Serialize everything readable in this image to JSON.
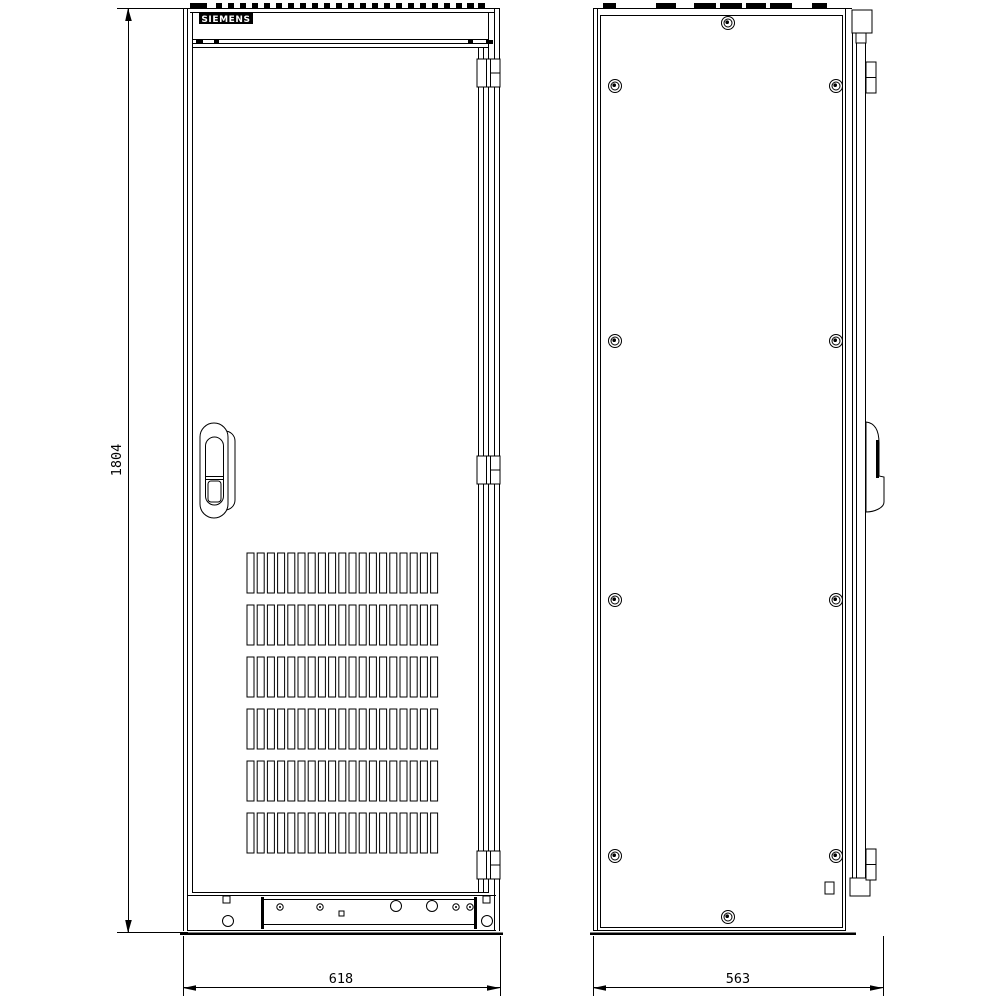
{
  "page": {
    "background": "#ffffff",
    "line_color": "#000000"
  },
  "brand": {
    "logo_text": "SIEMENS"
  },
  "dimensions": {
    "height": {
      "value": "1804"
    },
    "front_width": {
      "value": "618"
    },
    "side_depth": {
      "value": "563"
    }
  },
  "front_view": {
    "vents": {
      "rows": 6,
      "cols": 19,
      "x": 247,
      "y": 553,
      "slot_w": 7,
      "slot_h": 40,
      "col_pitch": 10.2,
      "row_pitch": 52
    },
    "top_dash_segments": [
      [
        190,
        17
      ],
      [
        216,
        6
      ],
      [
        228,
        6
      ],
      [
        240,
        6
      ],
      [
        252,
        6
      ],
      [
        264,
        6
      ],
      [
        276,
        6
      ],
      [
        288,
        6
      ],
      [
        300,
        6
      ],
      [
        312,
        6
      ],
      [
        324,
        6
      ],
      [
        336,
        6
      ],
      [
        348,
        6
      ],
      [
        360,
        6
      ],
      [
        372,
        6
      ],
      [
        384,
        6
      ],
      [
        396,
        6
      ],
      [
        408,
        6
      ],
      [
        420,
        6
      ],
      [
        432,
        6
      ],
      [
        444,
        6
      ],
      [
        456,
        6
      ],
      [
        467,
        7
      ],
      [
        478,
        7
      ]
    ],
    "bar_ticks": [
      [
        196,
        7
      ],
      [
        214,
        5
      ],
      [
        468,
        5
      ],
      [
        486,
        7
      ]
    ],
    "hinge_ys": [
      59,
      456,
      851
    ],
    "plinth_holes": [
      {
        "shape": "circle",
        "cx": 280,
        "cy": 907,
        "r": 3.2,
        "dot": true
      },
      {
        "shape": "circle",
        "cx": 320,
        "cy": 907,
        "r": 3.2,
        "dot": true
      },
      {
        "shape": "circle",
        "cx": 396,
        "cy": 906,
        "r": 5.5
      },
      {
        "shape": "square",
        "x": 339,
        "y": 911,
        "size": 5
      },
      {
        "shape": "circle",
        "cx": 432,
        "cy": 906,
        "r": 5.5
      },
      {
        "shape": "circle",
        "cx": 456,
        "cy": 907,
        "r": 3.2,
        "dot": true
      },
      {
        "shape": "circle",
        "cx": 470,
        "cy": 907,
        "r": 3.2,
        "dot": true
      },
      {
        "shape": "circle",
        "cx": 228,
        "cy": 921,
        "r": 5.5
      },
      {
        "shape": "circle",
        "cx": 487,
        "cy": 921,
        "r": 5.5
      },
      {
        "shape": "square",
        "x": 223,
        "y": 896,
        "size": 7
      },
      {
        "shape": "square",
        "x": 483,
        "y": 896,
        "size": 7
      }
    ]
  },
  "side_view": {
    "screws": [
      [
        615,
        86
      ],
      [
        836,
        86
      ],
      [
        615,
        341
      ],
      [
        836,
        341
      ],
      [
        615,
        600
      ],
      [
        836,
        600
      ],
      [
        615,
        856
      ],
      [
        836,
        856
      ],
      [
        728,
        23
      ],
      [
        728,
        917
      ]
    ],
    "top_tabs": [
      [
        603,
        13
      ],
      [
        656,
        20
      ],
      [
        694,
        22
      ],
      [
        720,
        22
      ],
      [
        746,
        20
      ],
      [
        770,
        22
      ],
      [
        812,
        15
      ]
    ],
    "hinge_ys": [
      62,
      849
    ]
  }
}
